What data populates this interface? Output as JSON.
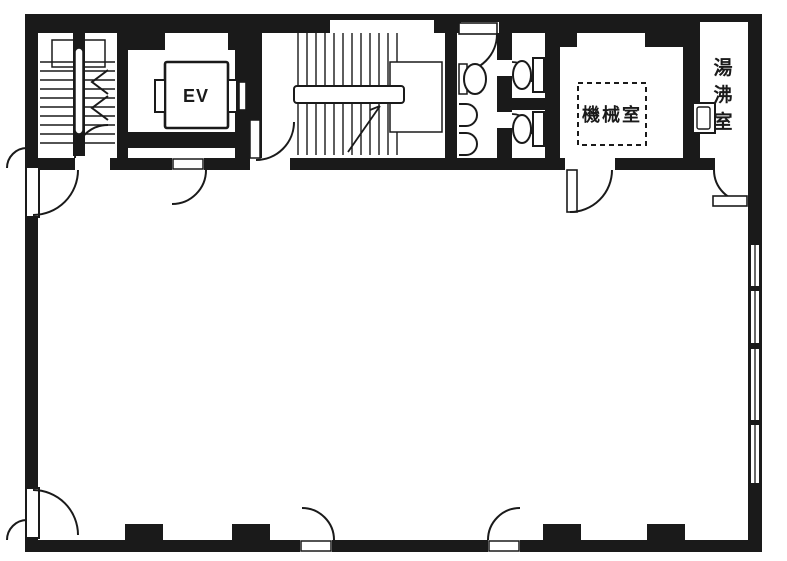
{
  "canvas": {
    "width": 787,
    "height": 561
  },
  "colors": {
    "wall": "#1a1a1a",
    "background": "#ffffff"
  },
  "rooms": {
    "elevator": {
      "label": "EV"
    },
    "machine_room": {
      "label": "機械室"
    },
    "kitchenette": {
      "label": "湯沸室",
      "label_chars": [
        "湯",
        "沸",
        "室"
      ]
    }
  }
}
